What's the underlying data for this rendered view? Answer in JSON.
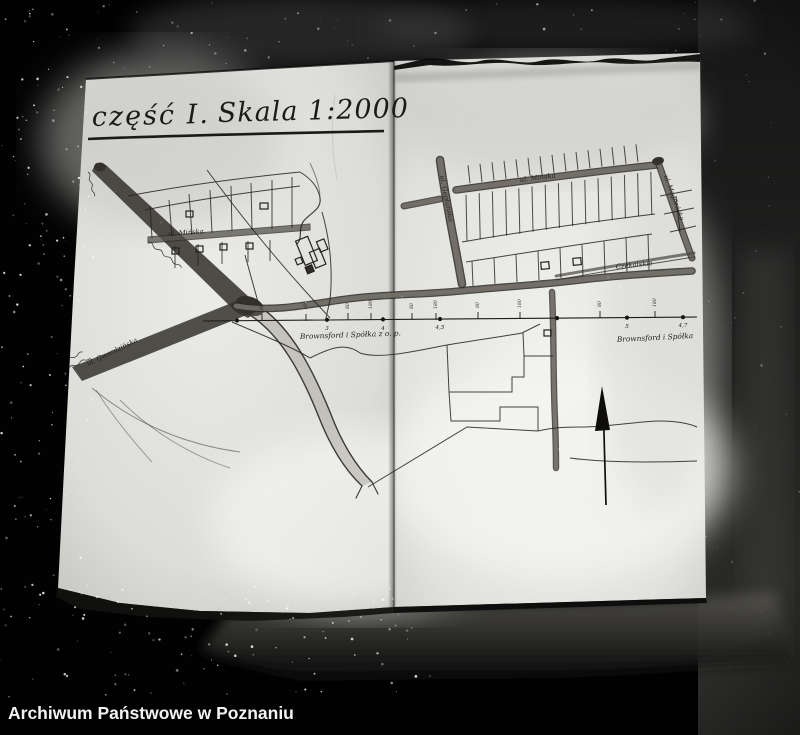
{
  "archive": {
    "caption": "Archiwum Państwowe w Poznaniu"
  },
  "map": {
    "title_part": "część I.",
    "title_scale": "Skala 1:2000",
    "streets": {
      "minska_left": "ul. Mińska",
      "gwardzinska": "ul. Gwardzińska",
      "goplanska": "ul. Gopłańska",
      "minska_right": "ul. Mińska",
      "mogilenska": "ul. Mogileńska",
      "czekalskie": "Czekalskie"
    },
    "owners": {
      "left": "Brownsford i Spółka z o. p.",
      "right": "Brownsford i Spółka"
    },
    "survey": {
      "ticks": [
        "80",
        "180",
        "80",
        "180",
        "80",
        "180",
        "80",
        "180",
        "80",
        "180"
      ],
      "stations": [
        "",
        "3",
        "4",
        "4,5",
        "",
        "5",
        "4,7"
      ]
    }
  }
}
